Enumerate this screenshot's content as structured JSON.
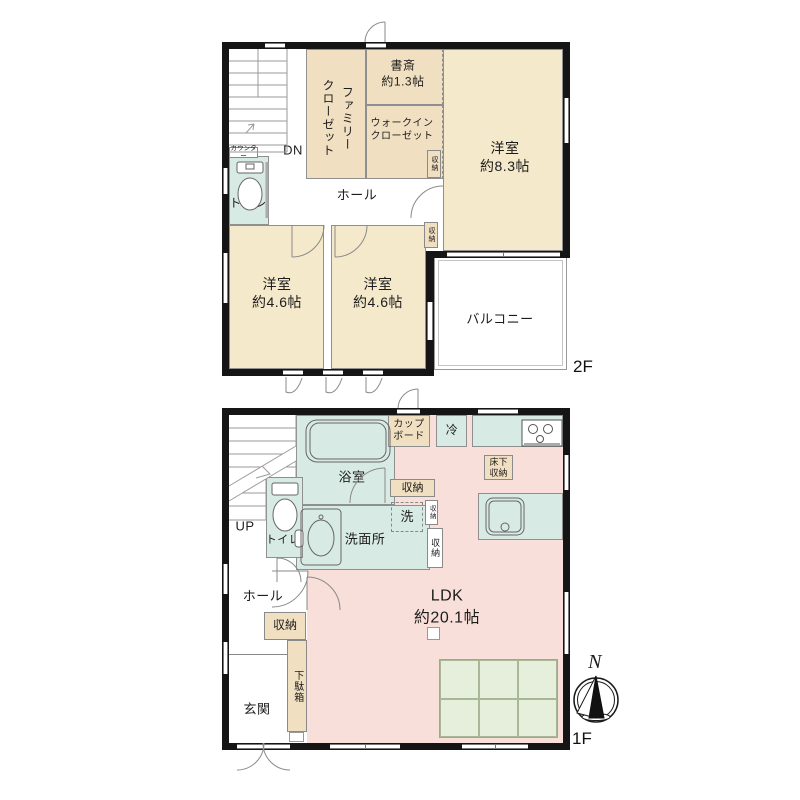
{
  "colors": {
    "wall": "#151515",
    "room_cream": "#f5e9cb",
    "closet_tan": "#f1dfc1",
    "wet_teal": "#d8eae4",
    "ldk_pink": "#f9dfda",
    "tatami_green": "#e6efdb"
  },
  "floor2": {
    "floor_label": "2F",
    "stairs_label": "DN",
    "counter": "カウンター",
    "toilet": "トイレ",
    "family_closet": "ファミリー\nクローゼット",
    "study": "書斎\n約1.3帖",
    "walkin_closet": "ウォークイン\nクローゼット",
    "storage_wic": "収納",
    "bedroom_main": "洋室\n約8.3帖",
    "hall": "ホール",
    "storage_mid": "収納",
    "bedroom_left": "洋室\n約4.6帖",
    "bedroom_right": "洋室\n約4.6帖",
    "balcony": "バルコニー"
  },
  "floor1": {
    "floor_label": "1F",
    "stairs_label": "UP",
    "toilet": "トイレ",
    "bathroom": "浴室",
    "cupboard": "カップ\nボード",
    "fridge": "冷",
    "storage_top": "収納",
    "kitchen_underfloor": "床下\n収納",
    "washer": "洗",
    "storage_mini": "収納",
    "washroom": "洗面所",
    "storage_side": "収納",
    "hall": "ホール",
    "storage_hall": "収納",
    "shoe_cabinet": "下駄箱",
    "entrance": "玄関",
    "ldk": "LDK\n約20.1帖"
  },
  "compass": {
    "north": "N"
  }
}
